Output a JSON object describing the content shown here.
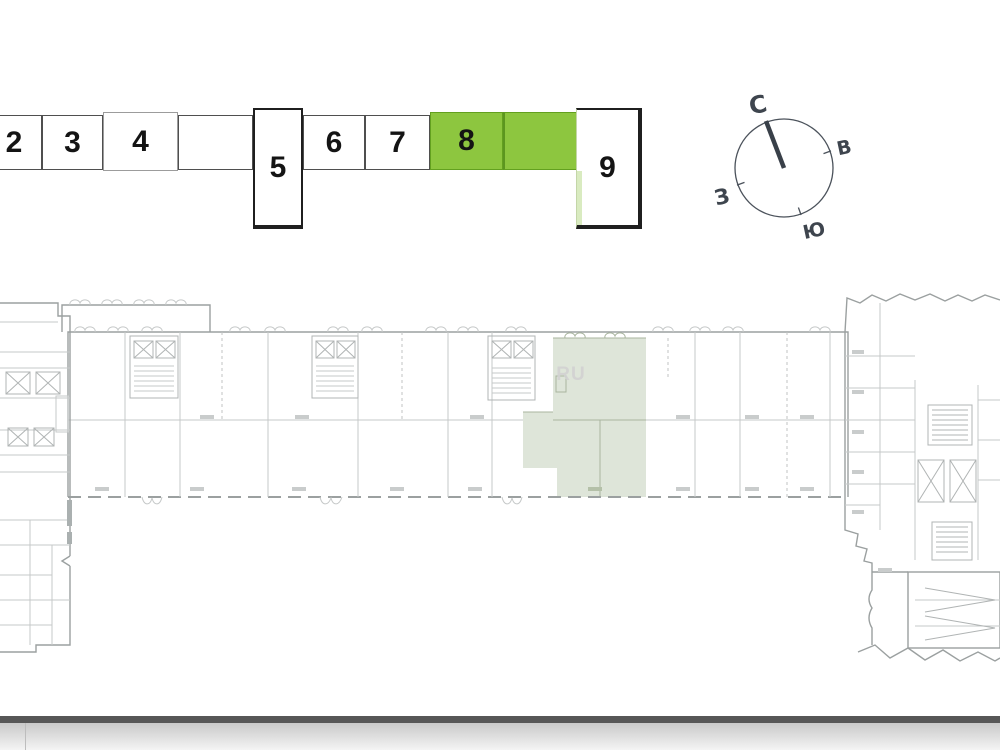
{
  "section_selector": {
    "sections": [
      {
        "label": "2",
        "selected": false
      },
      {
        "label": "3",
        "selected": false
      },
      {
        "label": "4",
        "selected": false
      },
      {
        "label": "",
        "selected": false
      },
      {
        "label": "5",
        "selected": false
      },
      {
        "label": "6",
        "selected": false
      },
      {
        "label": "7",
        "selected": false
      },
      {
        "label": "8",
        "selected": true
      },
      {
        "label": "",
        "selected": true
      },
      {
        "label": "9",
        "selected": false
      }
    ],
    "selected_color": "#8dc63f"
  },
  "compass": {
    "north_label": "С",
    "east_label": "В",
    "south_label": "Ю",
    "west_label": "З"
  },
  "floor_plan": {
    "watermark": "RU",
    "highlight_color": "#dee5d9"
  },
  "footer": {
    "bar_color": "#575757"
  }
}
